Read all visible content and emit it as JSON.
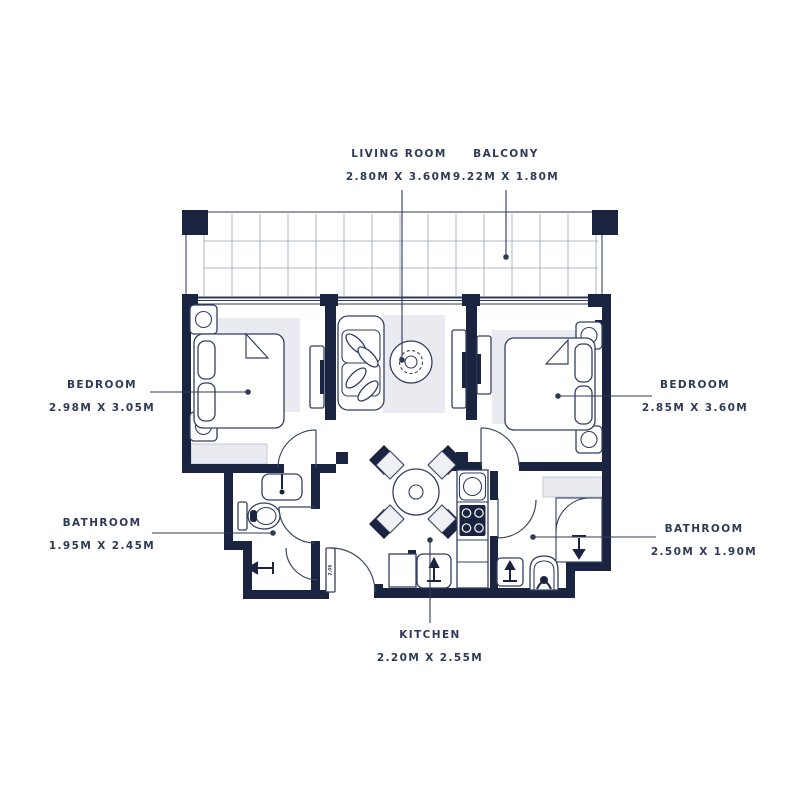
{
  "plan": {
    "labels": {
      "living_room": {
        "name": "LIVING ROOM",
        "dims": "2.80M X 3.60M"
      },
      "balcony": {
        "name": "BALCONY",
        "dims": "9.22M X 1.80M"
      },
      "bedroom_left": {
        "name": "BEDROOM",
        "dims": "2.98M X 3.05M"
      },
      "bedroom_right": {
        "name": "BEDROOM",
        "dims": "2.85M X 3.60M"
      },
      "bathroom_left": {
        "name": "BATHROOM",
        "dims": "1.95M X 2.45M"
      },
      "bathroom_right": {
        "name": "BATHROOM",
        "dims": "2.50M X 1.90M"
      },
      "kitchen": {
        "name": "KITCHEN",
        "dims": "2.20M X 2.55M"
      }
    },
    "door_tag": "2.06",
    "colors": {
      "wall": "#1a2340",
      "ink": "#2e3a57",
      "rug": "#e9ebf0"
    }
  }
}
